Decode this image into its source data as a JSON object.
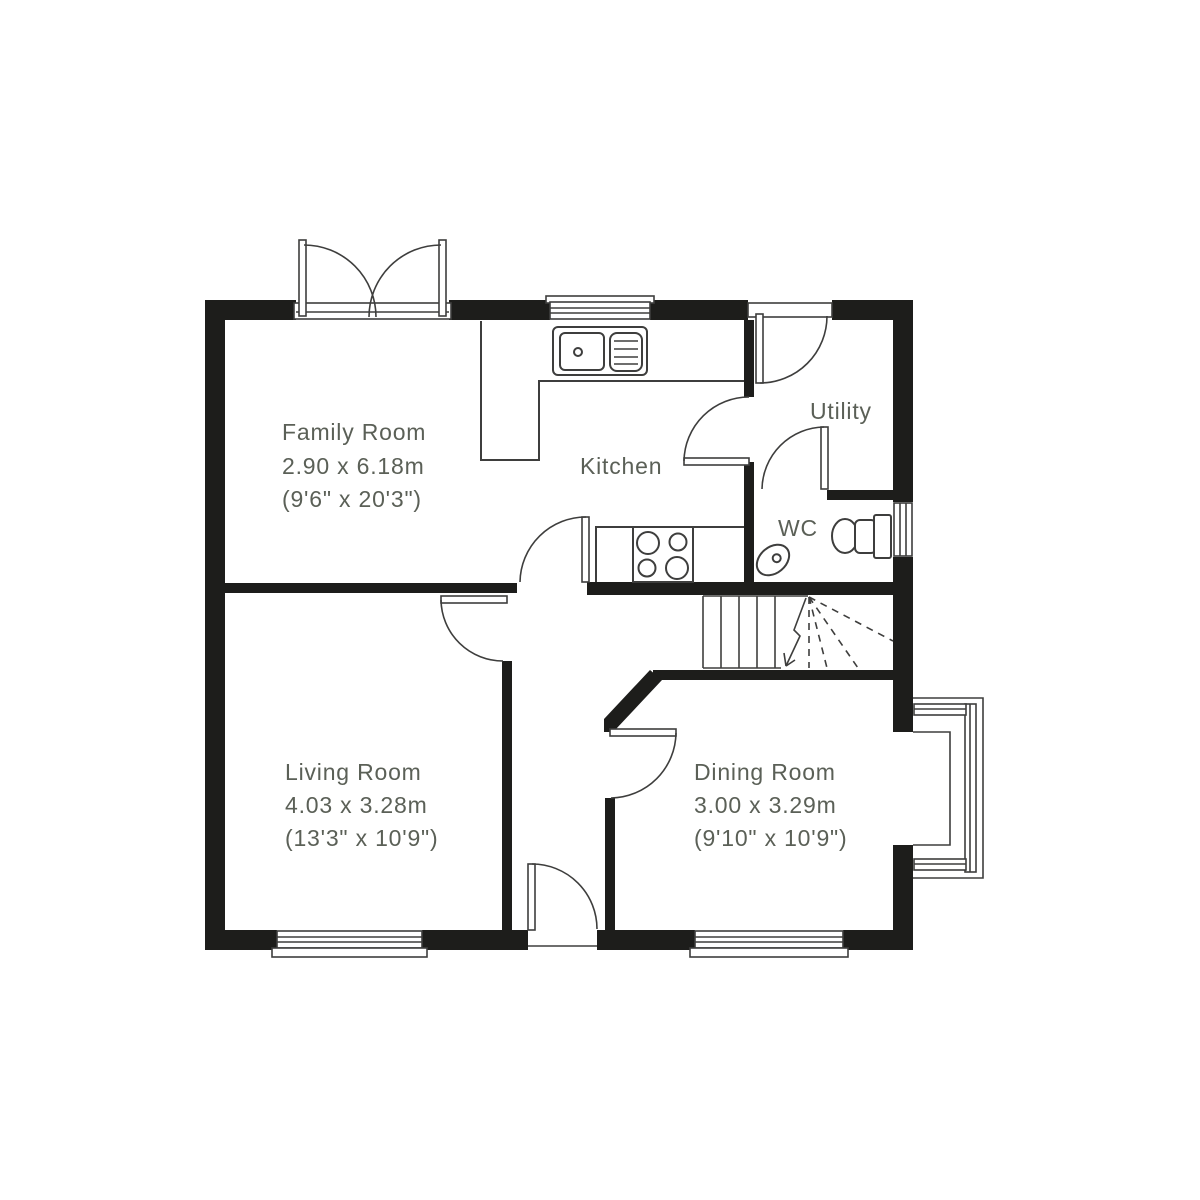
{
  "plan_type": "ground-floor-plan",
  "colors": {
    "wall": "#1d1d1b",
    "line": "#3e3e3d",
    "text": "#5b6057",
    "background": "#ffffff"
  },
  "rooms": {
    "family": {
      "name": "Family Room",
      "metric": "2.90 x 6.18m",
      "imperial": "(9'6\" x 20'3\")"
    },
    "kitchen": {
      "name": "Kitchen"
    },
    "utility": {
      "name": "Utility"
    },
    "wc": {
      "name": "WC"
    },
    "living": {
      "name": "Living Room",
      "metric": "4.03 x 3.28m",
      "imperial": "(13'3\" x 10'9\")"
    },
    "dining": {
      "name": "Dining Room",
      "metric": "3.00 x 3.29m",
      "imperial": "(9'10\" x 10'9\")"
    }
  },
  "fixtures": [
    "french-doors",
    "kitchen-window",
    "kitchen-sink",
    "kitchen-worktop",
    "hob",
    "utility-exterior-door",
    "kitchen-utility-door",
    "wc-door",
    "toilet",
    "wc-basin",
    "wc-window",
    "stairs",
    "kitchen-hall-door",
    "living-room-door",
    "dining-room-door",
    "front-door",
    "living-room-window",
    "dining-room-window",
    "bay-window"
  ]
}
